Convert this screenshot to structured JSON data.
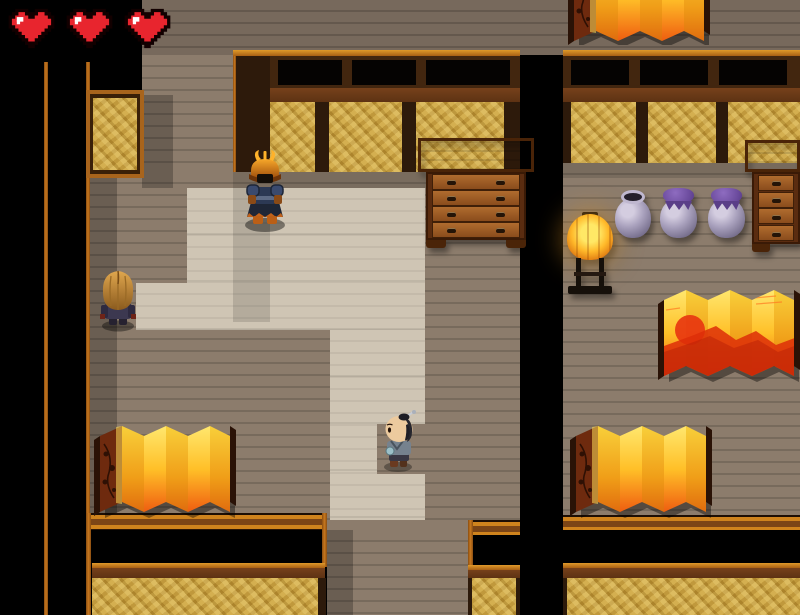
{
  "hud": {
    "hearts_count": 3,
    "heart_color": "#e8252e"
  },
  "scene": {
    "characters": [
      {
        "id": "armored-samurai-npc",
        "description": "samurai in dark blue armor with horned orange kabuto helmet"
      },
      {
        "id": "long-hair-npc",
        "description": "figure with long blonde hair seen from behind"
      },
      {
        "id": "player-topknot",
        "description": "small man with chonmage topknot and silver hairpin facing left"
      }
    ],
    "objects": [
      {
        "id": "chest-of-drawers-center",
        "drawers": 4
      },
      {
        "id": "chest-of-drawers-right",
        "drawers": 4
      },
      {
        "id": "standing-lantern"
      },
      {
        "id": "open-jar"
      },
      {
        "id": "covered-jar-1"
      },
      {
        "id": "covered-jar-2"
      },
      {
        "id": "folding-screen-top"
      },
      {
        "id": "folding-screen-sun"
      },
      {
        "id": "folding-screen-bottom-left"
      },
      {
        "id": "folding-screen-bottom-right"
      }
    ],
    "palette": {
      "floor": "#8c7c6c",
      "floor_shadow": "#6b5d50",
      "path": "#cfc5b4",
      "gold_wall": "#c39c3e",
      "wall_trim": "#c8781e",
      "wall_band": "#6a3a18",
      "void": "#000000",
      "screen_gold": "#ffc028",
      "screen_orange": "#ee5d10",
      "jar_purple": "#6a4a9c",
      "lantern_glow": "#ffb92a"
    }
  }
}
